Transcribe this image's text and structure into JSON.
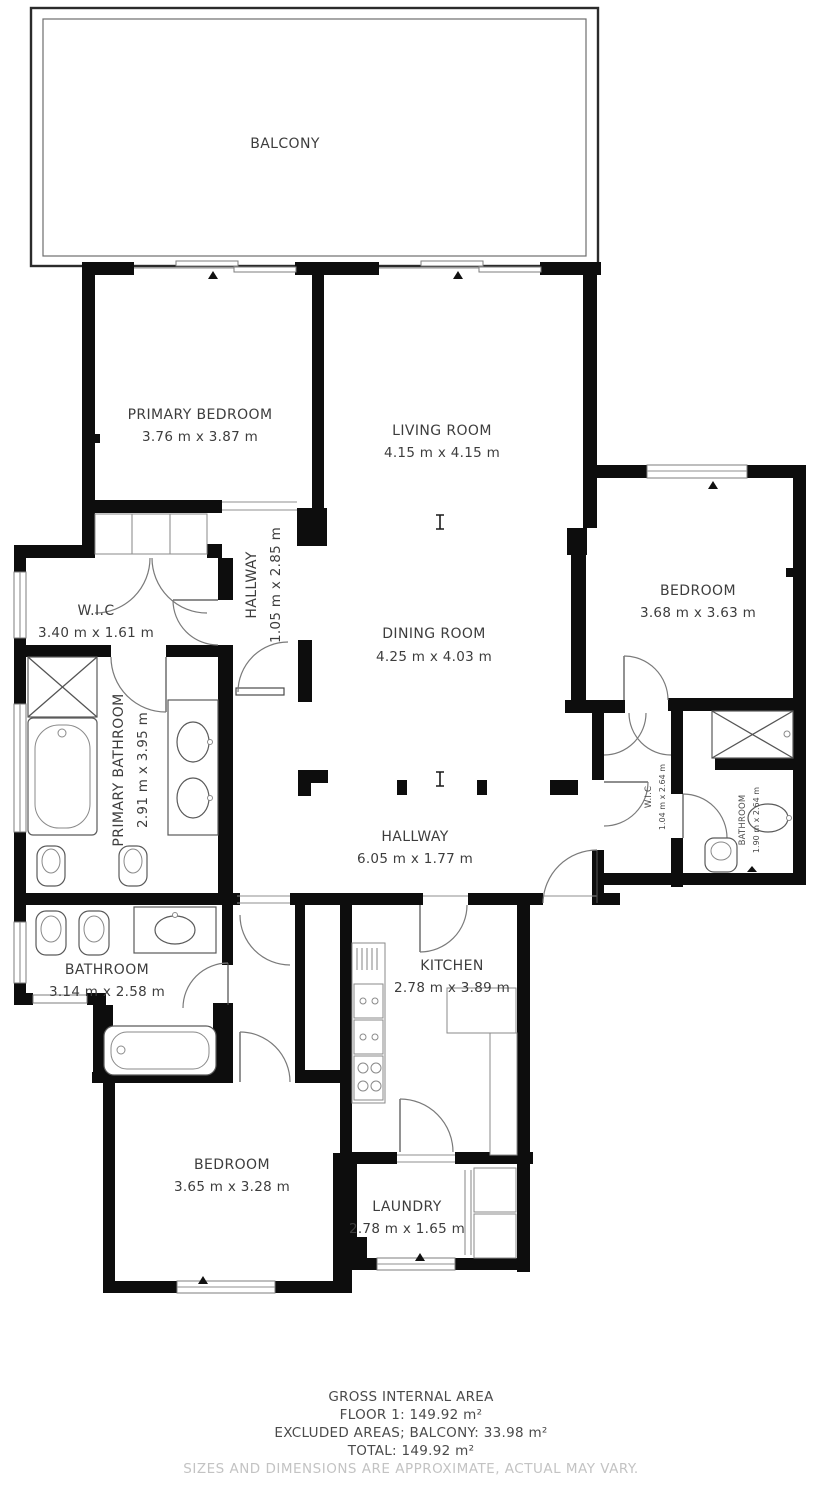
{
  "colors": {
    "wall": "#0d0d0d",
    "label_text": "#3d3d3d",
    "disclaimer_text": "#c3c3c3",
    "background": "#ffffff"
  },
  "floor_plan": {
    "rooms": [
      {
        "id": "balcony",
        "name": "BALCONY",
        "dims": ""
      },
      {
        "id": "primary-bedroom",
        "name": "PRIMARY BEDROOM",
        "dims": "3.76 m x 3.87 m"
      },
      {
        "id": "living-room",
        "name": "LIVING ROOM",
        "dims": "4.15 m x 4.15 m"
      },
      {
        "id": "hallway-upper",
        "name": "HALLWAY",
        "dims": "1.05 m x 2.85 m"
      },
      {
        "id": "wic-primary",
        "name": "W.I.C",
        "dims": "3.40 m x 1.61 m"
      },
      {
        "id": "dining-room",
        "name": "DINING ROOM",
        "dims": "4.25 m x 4.03 m"
      },
      {
        "id": "bedroom-right",
        "name": "BEDROOM",
        "dims": "3.68 m x 3.63 m"
      },
      {
        "id": "primary-bathroom",
        "name": "PRIMARY BATHROOM",
        "dims": "2.91 m x 3.95 m"
      },
      {
        "id": "hallway-main",
        "name": "HALLWAY",
        "dims": "6.05 m x 1.77 m"
      },
      {
        "id": "wic-right",
        "name": "W.I.C",
        "dims": "1.04 m x 2.64 m"
      },
      {
        "id": "bathroom-right",
        "name": "BATHROOM",
        "dims": "1.90 m x 2.64 m"
      },
      {
        "id": "bathroom-left",
        "name": "BATHROOM",
        "dims": "3.14 m x 2.58 m"
      },
      {
        "id": "kitchen",
        "name": "KITCHEN",
        "dims": "2.78 m x 3.89 m"
      },
      {
        "id": "bedroom-bottom",
        "name": "BEDROOM",
        "dims": "3.65 m x 3.28 m"
      },
      {
        "id": "laundry",
        "name": "LAUNDRY",
        "dims": "2.78 m x 1.65 m"
      }
    ]
  },
  "footer": {
    "line1": "GROSS INTERNAL AREA",
    "line2": "FLOOR 1: 149.92 m²",
    "line3": "EXCLUDED AREAS; BALCONY: 33.98 m²",
    "line4": "TOTAL: 149.92 m²",
    "disclaimer": "SIZES AND DIMENSIONS ARE APPROXIMATE, ACTUAL MAY VARY."
  }
}
